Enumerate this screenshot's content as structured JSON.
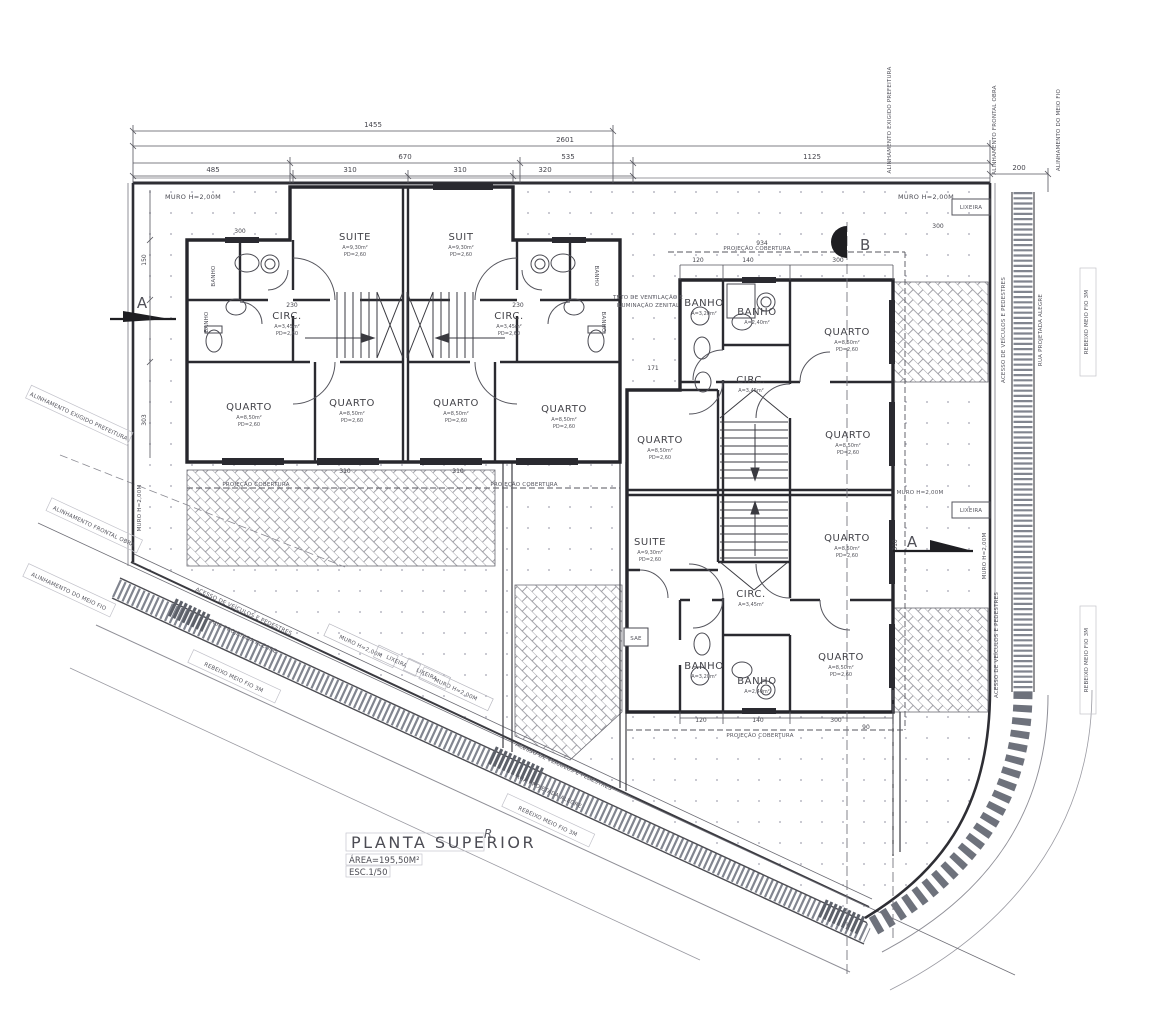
{
  "title_block": {
    "title": "PLANTA SUPERIOR",
    "area": "ÁREA=195,50M²",
    "scale": "ESC.1/50",
    "curve_mark": "R"
  },
  "section_markers": {
    "a": "A",
    "b": "B"
  },
  "site": {
    "muro": "MURO H=2,00M",
    "lixeira": "LIXEIRA",
    "projecao": "PROJEÇÃO COBERTURA",
    "alinhamento_prefeitura": "ALINHAMENTO EXIGIDO PREFEITURA",
    "alinhamento_frontal": "ALINHAMENTO FRONTAL OBRA",
    "alinhamento_meio_fio": "ALINHAMENTO DO MEIO FIO",
    "rebaixo": "REBEIXO MEIO FIO 3M",
    "acesso": "ACESSO DE VEÍCULOS E PEDESTRES",
    "rua": "RUA PROJETADA ALEGRE",
    "teto_linha1": "TETO DE VENTILAÇÃO E",
    "teto_linha2": "ILUMINAÇÃO ZENITAL",
    "sae": "SAE",
    "banho_vertical": "BANHO"
  },
  "rooms": [
    {
      "name": "SUITE",
      "sub1": "A=9,30m²",
      "sub2": "PD=2,60"
    },
    {
      "name": "SUIT",
      "sub1": "A=9,30m²",
      "sub2": "PD=2,60"
    },
    {
      "name": "CIRC.",
      "sub1": "A=3,45m²",
      "sub2": "PD=2,60"
    },
    {
      "name": "CIRC.",
      "sub1": "A=3,45m²",
      "sub2": "PD=2,60"
    },
    {
      "name": "QUARTO",
      "sub1": "A=8,50m²",
      "sub2": "PD=2,60"
    },
    {
      "name": "QUARTO",
      "sub1": "A=8,50m²",
      "sub2": "PD=2,60"
    },
    {
      "name": "QUARTO",
      "sub1": "A=8,50m²",
      "sub2": "PD=2,60"
    },
    {
      "name": "QUARTO",
      "sub1": "A=8,50m²",
      "sub2": "PD=2,60"
    },
    {
      "name": "BANHO",
      "sub1": "A=3,20m²",
      "sub2": "PD=2,60"
    },
    {
      "name": "BANHO",
      "sub1": "A=2,40m²",
      "sub2": "PD=2,60"
    },
    {
      "name": "QUARTO",
      "sub1": "A=8,50m²",
      "sub2": "PD=2,60"
    },
    {
      "name": "CIRC.",
      "sub1": "A=3,45m²",
      "sub2": "PD=2,60"
    },
    {
      "name": "QUARTO",
      "sub1": "A=8,50m²",
      "sub2": "PD=2,60"
    },
    {
      "name": "QUARTO",
      "sub1": "A=8,50m²",
      "sub2": "PD=2,60"
    },
    {
      "name": "SUITE",
      "sub1": "A=9,30m²",
      "sub2": "PD=2,60"
    },
    {
      "name": "QUARTO",
      "sub1": "A=8,50m²",
      "sub2": "PD=2,60"
    },
    {
      "name": "CIRC.",
      "sub1": "A=3,45m²",
      "sub2": "PD=2,60"
    },
    {
      "name": "BANHO",
      "sub1": "A=3,20m²",
      "sub2": "PD=2,60"
    },
    {
      "name": "BANHO",
      "sub1": "A=2,40m²",
      "sub2": "PD=2,60"
    },
    {
      "name": "QUARTO",
      "sub1": "A=8,50m²",
      "sub2": "PD=2,60"
    }
  ],
  "dims": {
    "v1455": "1455",
    "v2601": "2601",
    "v670": "670",
    "v535": "535",
    "v1125": "1125",
    "v485": "485",
    "v310": "310",
    "v320": "320",
    "v300": "300",
    "v200": "200",
    "v230": "230",
    "v120": "120",
    "v140": "140",
    "v934": "934",
    "v90": "90",
    "v150": "150",
    "v303": "303",
    "v171": "171"
  }
}
